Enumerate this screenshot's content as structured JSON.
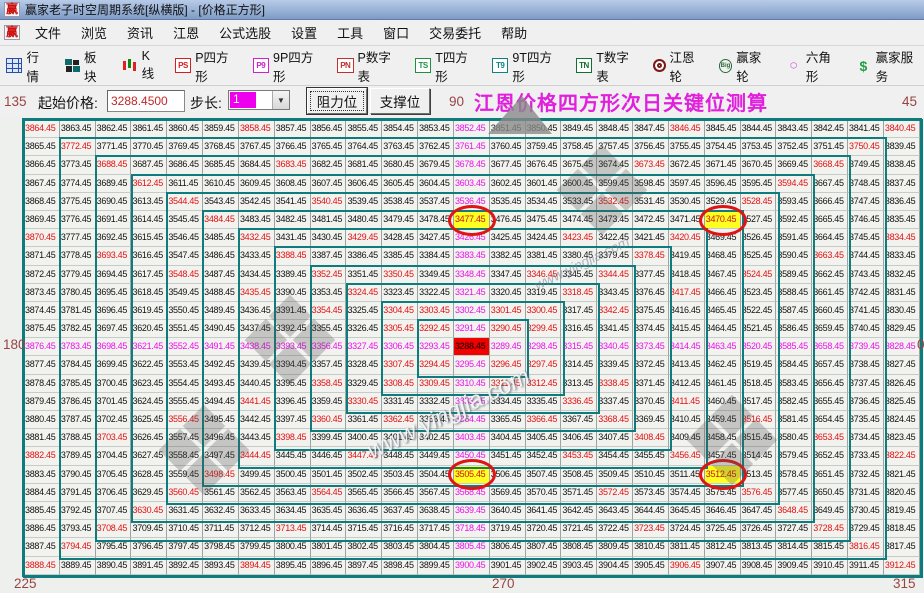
{
  "window": {
    "title": "赢家老子时空周期系统[纵横版] - [价格正方形]",
    "logo_text": "赢"
  },
  "menu": {
    "items": [
      "文件",
      "浏览",
      "资讯",
      "江恩",
      "公式选股",
      "设置",
      "工具",
      "窗口",
      "交易委托",
      "帮助"
    ]
  },
  "toolbar": {
    "items": [
      {
        "label": "行情",
        "icon": "market-grid-icon",
        "icon_text": ""
      },
      {
        "label": "板块",
        "icon": "sector-blocks-icon",
        "icon_text": ""
      },
      {
        "label": "K线",
        "icon": "candlestick-icon",
        "icon_text": ""
      },
      {
        "label": "P四方形",
        "icon": "p-square-icon",
        "icon_text": "PS"
      },
      {
        "label": "9P四方形",
        "icon": "p9-square-icon",
        "icon_text": "P9"
      },
      {
        "label": "P数字表",
        "icon": "p-number-table-icon",
        "icon_text": "PN"
      },
      {
        "label": "T四方形",
        "icon": "t-square-icon",
        "icon_text": "TS"
      },
      {
        "label": "9T四方形",
        "icon": "t9-square-icon",
        "icon_text": "T9"
      },
      {
        "label": "T数字表",
        "icon": "t-number-table-icon",
        "icon_text": "TN"
      },
      {
        "label": "江恩轮",
        "icon": "gann-wheel-icon",
        "icon_text": ""
      },
      {
        "label": "赢家轮",
        "icon": "winner-wheel-icon",
        "icon_text": "Big"
      },
      {
        "label": "六角形",
        "icon": "hexagon-icon",
        "icon_text": "⬡"
      },
      {
        "label": "赢家服务",
        "icon": "service-dollar-icon",
        "icon_text": "$"
      }
    ]
  },
  "controls": {
    "start_price_label": "起始价格:",
    "start_price_value": "3288.4500",
    "step_label": "步长:",
    "step_value": "1",
    "resistance_button": "阻力位",
    "support_button": "支撑位",
    "heading": "江恩价格四方形次日关键位测算"
  },
  "angle_labels": {
    "top_left": "135",
    "top_center": "90",
    "top_right": "45",
    "left": "180",
    "right": "0",
    "bottom_left": "225",
    "bottom_center": "270",
    "bottom_right": "315"
  },
  "watermark": {
    "text": "www.yingjia.com"
  },
  "colors": {
    "red": "#e31212",
    "magenta": "#ee11ee",
    "center_bg": "#f20000",
    "highlight_bg": "#ffff22",
    "ring_border": "#0e7c7c",
    "heading": "#e020dd",
    "angle_label": "#994444"
  },
  "grid": {
    "rows": 25,
    "cols": 25,
    "start_price": 3288.45,
    "step": 1,
    "center": {
      "row": 12,
      "col": 12,
      "value": 3288.45
    },
    "highlighted_cells": [
      {
        "row": 5,
        "col": 12,
        "value": 3477.45
      },
      {
        "row": 5,
        "col": 19,
        "value": 3470.45
      },
      {
        "row": 19,
        "col": 12,
        "value": 3505.45
      },
      {
        "row": 19,
        "col": 19,
        "value": 3512.45
      }
    ],
    "values": [
      [
        3864.45,
        3863.45,
        3862.45,
        3861.45,
        3860.45,
        3859.45,
        3858.45,
        3857.45,
        3856.45,
        3855.45,
        3854.45,
        3853.45,
        3852.45,
        3851.45,
        3850.45,
        3849.45,
        3848.45,
        3847.45,
        3846.45,
        3845.45,
        3844.45,
        3843.45,
        3842.45,
        3841.45,
        3840.45
      ],
      [
        3865.45,
        3772.45,
        3771.45,
        3770.45,
        3769.45,
        3768.45,
        3767.45,
        3766.45,
        3765.45,
        3764.45,
        3763.45,
        3762.45,
        3761.45,
        3760.45,
        3759.45,
        3758.45,
        3757.45,
        3756.45,
        3755.45,
        3754.45,
        3753.45,
        3752.45,
        3751.45,
        3750.45,
        3839.45
      ],
      [
        3866.45,
        3773.45,
        3688.45,
        3687.45,
        3686.45,
        3685.45,
        3684.45,
        3683.45,
        3682.45,
        3681.45,
        3680.45,
        3679.45,
        3678.45,
        3677.45,
        3676.45,
        3675.45,
        3674.45,
        3673.45,
        3672.45,
        3671.45,
        3670.45,
        3669.45,
        3668.45,
        3749.45,
        3838.45
      ],
      [
        3867.45,
        3774.45,
        3689.45,
        3612.45,
        3611.45,
        3610.45,
        3609.45,
        3608.45,
        3607.45,
        3606.45,
        3605.45,
        3604.45,
        3603.45,
        3602.45,
        3601.45,
        3600.45,
        3599.45,
        3598.45,
        3597.45,
        3596.45,
        3595.45,
        3594.45,
        3667.45,
        3748.45,
        3837.45
      ],
      [
        3868.45,
        3775.45,
        3690.45,
        3613.45,
        3544.45,
        3543.45,
        3542.45,
        3541.45,
        3540.45,
        3539.45,
        3538.45,
        3537.45,
        3536.45,
        3535.45,
        3534.45,
        3533.45,
        3532.45,
        3531.45,
        3530.45,
        3529.45,
        3528.45,
        3593.45,
        3666.45,
        3747.45,
        3836.45
      ],
      [
        3869.45,
        3776.45,
        3691.45,
        3614.45,
        3545.45,
        3484.45,
        3483.45,
        3482.45,
        3481.45,
        3480.45,
        3479.45,
        3478.45,
        3477.45,
        3476.45,
        3475.45,
        3474.45,
        3473.45,
        3472.45,
        3471.45,
        3470.45,
        3527.45,
        3592.45,
        3665.45,
        3746.45,
        3835.45
      ],
      [
        3870.45,
        3777.45,
        3692.45,
        3615.45,
        3546.45,
        3485.45,
        3432.45,
        3431.45,
        3430.45,
        3429.45,
        3428.45,
        3427.45,
        3426.45,
        3425.45,
        3424.45,
        3423.45,
        3422.45,
        3421.45,
        3420.45,
        3469.45,
        3526.45,
        3591.45,
        3664.45,
        3745.45,
        3834.45
      ],
      [
        3871.45,
        3778.45,
        3693.45,
        3616.45,
        3547.45,
        3486.45,
        3433.45,
        3388.45,
        3387.45,
        3386.45,
        3385.45,
        3384.45,
        3383.45,
        3382.45,
        3381.45,
        3380.45,
        3379.45,
        3378.45,
        3419.45,
        3468.45,
        3525.45,
        3590.45,
        3663.45,
        3744.45,
        3833.45
      ],
      [
        3872.45,
        3779.45,
        3694.45,
        3617.45,
        3548.45,
        3487.45,
        3434.45,
        3389.45,
        3352.45,
        3351.45,
        3350.45,
        3349.45,
        3348.45,
        3347.45,
        3346.45,
        3345.45,
        3344.45,
        3377.45,
        3418.45,
        3467.45,
        3524.45,
        3589.45,
        3662.45,
        3743.45,
        3832.45
      ],
      [
        3873.45,
        3780.45,
        3695.45,
        3618.45,
        3549.45,
        3488.45,
        3435.45,
        3390.45,
        3353.45,
        3324.45,
        3323.45,
        3322.45,
        3321.45,
        3320.45,
        3319.45,
        3318.45,
        3343.45,
        3376.45,
        3417.45,
        3466.45,
        3523.45,
        3588.45,
        3661.45,
        3742.45,
        3831.45
      ],
      [
        3874.45,
        3781.45,
        3696.45,
        3619.45,
        3550.45,
        3489.45,
        3436.45,
        3391.45,
        3354.45,
        3325.45,
        3304.45,
        3303.45,
        3302.45,
        3301.45,
        3300.45,
        3317.45,
        3342.45,
        3375.45,
        3416.45,
        3465.45,
        3522.45,
        3587.45,
        3660.45,
        3741.45,
        3830.45
      ],
      [
        3875.45,
        3782.45,
        3697.45,
        3620.45,
        3551.45,
        3490.45,
        3437.45,
        3392.45,
        3355.45,
        3326.45,
        3305.45,
        3292.45,
        3291.45,
        3290.45,
        3299.45,
        3316.45,
        3341.45,
        3374.45,
        3415.45,
        3464.45,
        3521.45,
        3586.45,
        3659.45,
        3740.45,
        3829.45
      ],
      [
        3876.45,
        3783.45,
        3698.45,
        3621.45,
        3552.45,
        3491.45,
        3438.45,
        3393.45,
        3356.45,
        3327.45,
        3306.45,
        3293.45,
        3288.45,
        3289.45,
        3298.45,
        3315.45,
        3340.45,
        3373.45,
        3414.45,
        3463.45,
        3520.45,
        3585.45,
        3658.45,
        3739.45,
        3828.45
      ],
      [
        3877.45,
        3784.45,
        3699.45,
        3622.45,
        3553.45,
        3492.45,
        3439.45,
        3394.45,
        3357.45,
        3328.45,
        3307.45,
        3294.45,
        3295.45,
        3296.45,
        3297.45,
        3314.45,
        3339.45,
        3372.45,
        3413.45,
        3462.45,
        3519.45,
        3584.45,
        3657.45,
        3738.45,
        3827.45
      ],
      [
        3878.45,
        3785.45,
        3700.45,
        3623.45,
        3554.45,
        3493.45,
        3440.45,
        3395.45,
        3358.45,
        3329.45,
        3308.45,
        3309.45,
        3310.45,
        3311.45,
        3312.45,
        3313.45,
        3338.45,
        3371.45,
        3412.45,
        3461.45,
        3518.45,
        3583.45,
        3656.45,
        3737.45,
        3826.45
      ],
      [
        3879.45,
        3786.45,
        3701.45,
        3624.45,
        3555.45,
        3494.45,
        3441.45,
        3396.45,
        3359.45,
        3330.45,
        3331.45,
        3332.45,
        3333.45,
        3334.45,
        3335.45,
        3336.45,
        3337.45,
        3370.45,
        3411.45,
        3460.45,
        3517.45,
        3582.45,
        3655.45,
        3736.45,
        3825.45
      ],
      [
        3880.45,
        3787.45,
        3702.45,
        3625.45,
        3556.45,
        3495.45,
        3442.45,
        3397.45,
        3360.45,
        3361.45,
        3362.45,
        3363.45,
        3364.45,
        3365.45,
        3366.45,
        3367.45,
        3368.45,
        3369.45,
        3410.45,
        3459.45,
        3516.45,
        3581.45,
        3654.45,
        3735.45,
        3824.45
      ],
      [
        3881.45,
        3788.45,
        3703.45,
        3626.45,
        3557.45,
        3496.45,
        3443.45,
        3398.45,
        3399.45,
        3400.45,
        3401.45,
        3402.45,
        3403.45,
        3404.45,
        3405.45,
        3406.45,
        3407.45,
        3408.45,
        3409.45,
        3458.45,
        3515.45,
        3580.45,
        3653.45,
        3734.45,
        3823.45
      ],
      [
        3882.45,
        3789.45,
        3704.45,
        3627.45,
        3558.45,
        3497.45,
        3444.45,
        3445.45,
        3446.45,
        3447.45,
        3448.45,
        3449.45,
        3450.45,
        3451.45,
        3452.45,
        3453.45,
        3454.45,
        3455.45,
        3456.45,
        3457.45,
        3514.45,
        3579.45,
        3652.45,
        3733.45,
        3822.45
      ],
      [
        3883.45,
        3790.45,
        3705.45,
        3628.45,
        3559.45,
        3498.45,
        3499.45,
        3500.45,
        3501.45,
        3502.45,
        3503.45,
        3504.45,
        3505.45,
        3506.45,
        3507.45,
        3508.45,
        3509.45,
        3510.45,
        3511.45,
        3512.45,
        3513.45,
        3578.45,
        3651.45,
        3732.45,
        3821.45
      ],
      [
        3884.45,
        3791.45,
        3706.45,
        3629.45,
        3560.45,
        3561.45,
        3562.45,
        3563.45,
        3564.45,
        3565.45,
        3566.45,
        3567.45,
        3568.45,
        3569.45,
        3570.45,
        3571.45,
        3572.45,
        3573.45,
        3574.45,
        3575.45,
        3576.45,
        3577.45,
        3650.45,
        3731.45,
        3820.45
      ],
      [
        3885.45,
        3792.45,
        3707.45,
        3630.45,
        3631.45,
        3632.45,
        3633.45,
        3634.45,
        3635.45,
        3636.45,
        3637.45,
        3638.45,
        3639.45,
        3640.45,
        3641.45,
        3642.45,
        3643.45,
        3644.45,
        3645.45,
        3646.45,
        3647.45,
        3648.45,
        3649.45,
        3730.45,
        3819.45
      ],
      [
        3886.45,
        3793.45,
        3708.45,
        3709.45,
        3710.45,
        3711.45,
        3712.45,
        3713.45,
        3714.45,
        3715.45,
        3716.45,
        3717.45,
        3718.45,
        3719.45,
        3720.45,
        3721.45,
        3722.45,
        3723.45,
        3724.45,
        3725.45,
        3726.45,
        3727.45,
        3728.45,
        3729.45,
        3818.45
      ],
      [
        3887.45,
        3794.45,
        3795.45,
        3796.45,
        3797.45,
        3798.45,
        3799.45,
        3800.45,
        3801.45,
        3802.45,
        3803.45,
        3804.45,
        3805.45,
        3806.45,
        3807.45,
        3808.45,
        3809.45,
        3810.45,
        3811.45,
        3812.45,
        3813.45,
        3814.45,
        3815.45,
        3816.45,
        3817.45
      ],
      [
        3888.45,
        3889.45,
        3890.45,
        3891.45,
        3892.45,
        3893.45,
        3894.45,
        3895.45,
        3896.45,
        3897.45,
        3898.45,
        3899.45,
        3900.45,
        3901.45,
        3902.45,
        3903.45,
        3904.45,
        3905.45,
        3906.45,
        3907.45,
        3908.45,
        3909.45,
        3910.45,
        3911.45,
        3912.45
      ]
    ]
  }
}
